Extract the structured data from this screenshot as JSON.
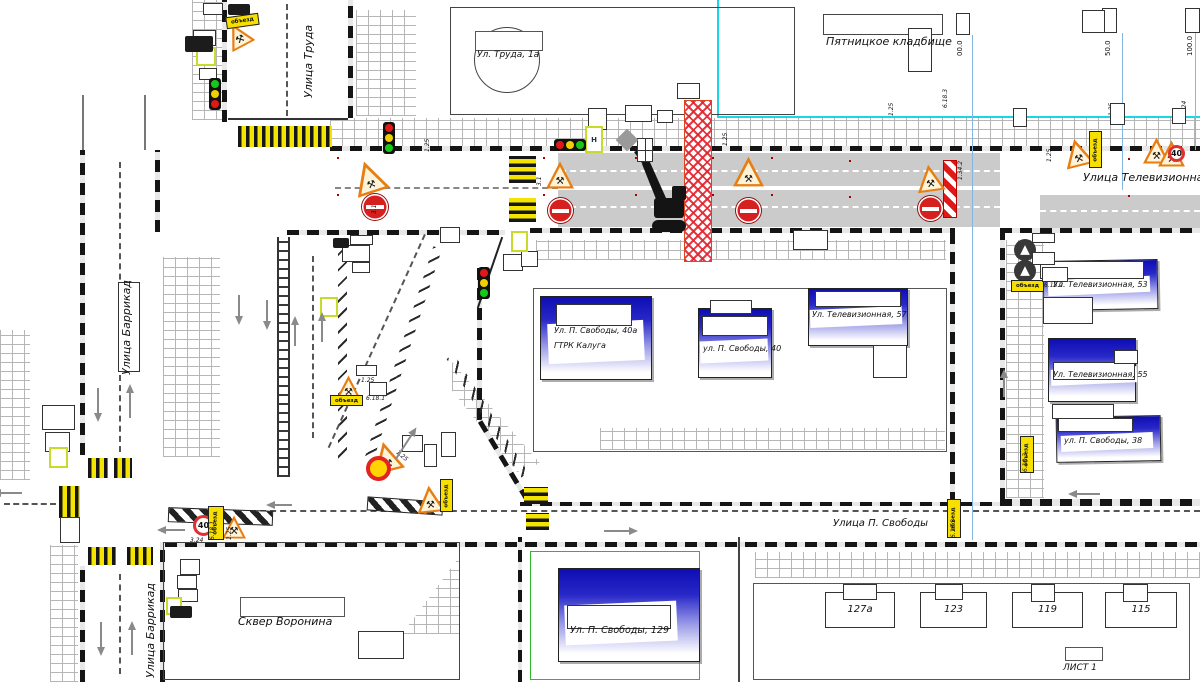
{
  "streets": {
    "truda": "Улица Труда",
    "barrikad_upper": "Улица Баррикад",
    "barrikad_lower": "Улица Баррикад",
    "televizionnaya": "Улица Телевизионная",
    "svobody": "Улица П. Свободы"
  },
  "places": {
    "cemetery": "Пятницкое кладбище",
    "park": "Сквер Воронина",
    "sheet": "ЛИСТ 1"
  },
  "buildings": {
    "truda1a": "Ул. Труда, 1а",
    "svobody40a_line1": "Ул. П. Свободы, 40а",
    "svobody40a_line2": "ГТРК  Калуга",
    "svobody40": "ул. П. Свободы, 40",
    "tv57": "Ул. Телевизионная, 57",
    "tv53": "Ул. Телевизионная, 53",
    "tv55": "Ул. Телевизионная, 55",
    "svobody38": "ул. П. Свободы, 38",
    "svobody129": "Ул. П. Свободы, 129",
    "b127a": "127а",
    "b123": "123",
    "b119": "119",
    "b115": "115"
  },
  "measurements": [
    "00.0",
    "50.0",
    "100.0"
  ],
  "icons": {
    "roadworks-icon": "⚒"
  },
  "colors": {
    "accent_blue_building": "#0d0db4",
    "work_zone_red": "#e12330",
    "crosswalk_yellow": "#f4e400",
    "detour_plate_yellow": "#f7df00",
    "cyan_line": "#18d8e8",
    "closed_lane_gray": "#cbcbcb"
  },
  "markers": [
    {
      "t": "cwv",
      "x": 238,
      "y": 126,
      "w": 94,
      "h": 21
    },
    {
      "t": "cwv",
      "x": 88,
      "y": 458,
      "w": 20,
      "h": 20
    },
    {
      "t": "cwv",
      "x": 114,
      "y": 458,
      "w": 18,
      "h": 20
    },
    {
      "t": "cwv",
      "x": 88,
      "y": 547,
      "w": 28,
      "h": 18
    },
    {
      "t": "cwv",
      "x": 127,
      "y": 547,
      "w": 26,
      "h": 18
    },
    {
      "t": "cwv",
      "x": 59,
      "y": 486,
      "w": 21,
      "h": 32
    },
    {
      "t": "cwh",
      "x": 509,
      "y": 156,
      "w": 27,
      "h": 27
    },
    {
      "t": "cwh",
      "x": 509,
      "y": 198,
      "w": 27,
      "h": 24
    },
    {
      "t": "cwh",
      "x": 524,
      "y": 487,
      "w": 24,
      "h": 17
    },
    {
      "t": "cwh",
      "x": 526,
      "y": 513,
      "w": 23,
      "h": 17
    },
    {
      "t": "bar",
      "x": 168,
      "y": 509,
      "w": 105,
      "h": 15,
      "r": 2
    },
    {
      "t": "bar",
      "x": 367,
      "y": 499,
      "w": 76,
      "h": 14,
      "r": 4
    },
    {
      "t": "post",
      "x": 337,
      "y": 157
    },
    {
      "t": "post",
      "x": 337,
      "y": 194
    },
    {
      "t": "post",
      "x": 543,
      "y": 157
    },
    {
      "t": "post",
      "x": 543,
      "y": 194
    },
    {
      "t": "post",
      "x": 635,
      "y": 157
    },
    {
      "t": "post",
      "x": 635,
      "y": 194
    },
    {
      "t": "post",
      "x": 712,
      "y": 157
    },
    {
      "t": "post",
      "x": 712,
      "y": 194
    },
    {
      "t": "post",
      "x": 771,
      "y": 157
    },
    {
      "t": "post",
      "x": 771,
      "y": 194
    },
    {
      "t": "post",
      "x": 849,
      "y": 160
    },
    {
      "t": "post",
      "x": 849,
      "y": 196
    },
    {
      "t": "post",
      "x": 1128,
      "y": 158
    },
    {
      "t": "post",
      "x": 1128,
      "y": 195
    },
    {
      "t": "chev",
      "x": 943,
      "y": 160,
      "w": 14,
      "h": 58
    },
    {
      "t": "tri",
      "x": 225,
      "y": 22,
      "s": 26,
      "r": -28
    },
    {
      "t": "tri",
      "x": 352,
      "y": 160,
      "s": 34,
      "r": -18
    },
    {
      "t": "tri",
      "x": 546,
      "y": 161,
      "s": 28
    },
    {
      "t": "tri",
      "x": 733,
      "y": 156,
      "s": 31
    },
    {
      "t": "tri",
      "x": 916,
      "y": 164,
      "s": 28,
      "r": -8
    },
    {
      "t": "tri",
      "x": 1063,
      "y": 138,
      "s": 29,
      "r": -14
    },
    {
      "t": "tri",
      "x": 1143,
      "y": 137,
      "s": 27
    },
    {
      "t": "tri",
      "x": 1158,
      "y": 140,
      "s": 27
    },
    {
      "t": "tri",
      "x": 336,
      "y": 375,
      "s": 25
    },
    {
      "t": "tri",
      "x": 371,
      "y": 441,
      "s": 31,
      "r": -14
    },
    {
      "t": "tri",
      "x": 416,
      "y": 485,
      "s": 28,
      "r": -6
    },
    {
      "t": "tri",
      "x": 222,
      "y": 515,
      "s": 24
    },
    {
      "t": "ne",
      "x": 362,
      "y": 194,
      "d": 26
    },
    {
      "t": "ne",
      "x": 548,
      "y": 198,
      "d": 25
    },
    {
      "t": "ne",
      "x": 736,
      "y": 198,
      "d": 25
    },
    {
      "t": "ne",
      "x": 918,
      "y": 196,
      "d": 25
    },
    {
      "t": "s40",
      "x": 193,
      "y": 515,
      "d": 21,
      "label": "40"
    },
    {
      "t": "s40",
      "x": 1168,
      "y": 145,
      "d": 17,
      "label": "40"
    },
    {
      "t": "ts",
      "x": 366,
      "y": 456,
      "d": 25
    },
    {
      "t": "dc",
      "x": 1014,
      "y": 239,
      "d": 22
    },
    {
      "t": "dc",
      "x": 1014,
      "y": 260,
      "d": 22
    },
    {
      "t": "dc",
      "x": 62,
      "y": 520,
      "d": 15
    },
    {
      "t": "ph",
      "x": 226,
      "y": 15,
      "w": 33,
      "h": 12,
      "r": -8,
      "label": "объезд"
    },
    {
      "t": "ph",
      "x": 1011,
      "y": 280,
      "w": 33,
      "h": 12,
      "label": "объезд"
    },
    {
      "t": "ph",
      "x": 330,
      "y": 395,
      "w": 33,
      "h": 11,
      "label": "объезд"
    },
    {
      "t": "pv",
      "x": 1089,
      "y": 131,
      "w": 13,
      "h": 37,
      "label": "объезд"
    },
    {
      "t": "pv",
      "x": 1020,
      "y": 436,
      "w": 14,
      "h": 37,
      "label": "объезд"
    },
    {
      "t": "pv",
      "x": 947,
      "y": 499,
      "w": 14,
      "h": 39,
      "label": "объезд"
    },
    {
      "t": "pv",
      "x": 208,
      "y": 506,
      "w": 16,
      "h": 34,
      "label": "объезд"
    },
    {
      "t": "pv",
      "x": 440,
      "y": 479,
      "w": 13,
      "h": 33,
      "label": "объезд"
    },
    {
      "t": "code",
      "x": 424,
      "y": 152,
      "r": 90,
      "label": "1.25"
    },
    {
      "t": "code",
      "x": 371,
      "y": 214,
      "r": 90,
      "label": "3.1"
    },
    {
      "t": "code",
      "x": 536,
      "y": 186,
      "r": 90,
      "label": "3.1"
    },
    {
      "t": "code",
      "x": 722,
      "y": 146,
      "r": 90,
      "label": "1.25"
    },
    {
      "t": "code",
      "x": 888,
      "y": 116,
      "r": 90,
      "label": "1.25"
    },
    {
      "t": "code",
      "x": 942,
      "y": 108,
      "r": 90,
      "label": "6.18.3"
    },
    {
      "t": "code",
      "x": 957,
      "y": 180,
      "r": 90,
      "label": "1.34.2"
    },
    {
      "t": "code",
      "x": 1108,
      "y": 116,
      "r": 90,
      "label": "1.25"
    },
    {
      "t": "code",
      "x": 1181,
      "y": 114,
      "r": 90,
      "label": "3.24"
    },
    {
      "t": "code",
      "x": 1046,
      "y": 162,
      "r": 90,
      "label": "1.25"
    },
    {
      "t": "code",
      "x": 361,
      "y": 377,
      "label": "1.25"
    },
    {
      "t": "code",
      "x": 366,
      "y": 395,
      "label": "6.18.1"
    },
    {
      "t": "code",
      "x": 399,
      "y": 449,
      "r": -40,
      "label": "1.25"
    },
    {
      "t": "code",
      "x": 428,
      "y": 464,
      "r": 90,
      "label": "6.18.1"
    },
    {
      "t": "code",
      "x": 190,
      "y": 537,
      "label": "3.24"
    },
    {
      "t": "code",
      "x": 209,
      "y": 540,
      "r": 90,
      "label": "6.18.1"
    },
    {
      "t": "code",
      "x": 226,
      "y": 540,
      "r": 90,
      "label": "1.25"
    },
    {
      "t": "code",
      "x": 1044,
      "y": 282,
      "label": "6.18.2"
    },
    {
      "t": "code",
      "x": 1022,
      "y": 472,
      "r": 90,
      "label": "6.18.3"
    },
    {
      "t": "code",
      "x": 950,
      "y": 538,
      "r": 90,
      "label": "6.18.3"
    },
    {
      "t": "box",
      "x": 203,
      "y": 3,
      "w": 20,
      "h": 12
    },
    {
      "t": "box",
      "x": 193,
      "y": 30,
      "w": 23,
      "h": 16
    },
    {
      "t": "box",
      "x": 199,
      "y": 68,
      "w": 18,
      "h": 12
    },
    {
      "t": "box",
      "x": 588,
      "y": 108,
      "w": 19,
      "h": 22
    },
    {
      "t": "box",
      "x": 625,
      "y": 105,
      "w": 27,
      "h": 17
    },
    {
      "t": "box",
      "x": 657,
      "y": 110,
      "w": 16,
      "h": 13
    },
    {
      "t": "box",
      "x": 677,
      "y": 83,
      "w": 23,
      "h": 16
    },
    {
      "t": "box",
      "x": 956,
      "y": 13,
      "w": 14,
      "h": 22
    },
    {
      "t": "box",
      "x": 1102,
      "y": 8,
      "w": 15,
      "h": 25
    },
    {
      "t": "box",
      "x": 1185,
      "y": 8,
      "w": 15,
      "h": 25
    },
    {
      "t": "box",
      "x": 1082,
      "y": 10,
      "w": 23,
      "h": 23
    },
    {
      "t": "box",
      "x": 908,
      "y": 28,
      "w": 24,
      "h": 44
    },
    {
      "t": "box",
      "x": 1013,
      "y": 108,
      "w": 14,
      "h": 19
    },
    {
      "t": "box",
      "x": 1110,
      "y": 103,
      "w": 15,
      "h": 22
    },
    {
      "t": "box",
      "x": 1172,
      "y": 108,
      "w": 14,
      "h": 16
    },
    {
      "t": "box",
      "x": 350,
      "y": 235,
      "w": 23,
      "h": 10
    },
    {
      "t": "box",
      "x": 342,
      "y": 245,
      "w": 28,
      "h": 17
    },
    {
      "t": "box",
      "x": 352,
      "y": 262,
      "w": 18,
      "h": 11
    },
    {
      "t": "box",
      "x": 440,
      "y": 227,
      "w": 20,
      "h": 16
    },
    {
      "t": "box",
      "x": 503,
      "y": 254,
      "w": 20,
      "h": 17
    },
    {
      "t": "box",
      "x": 521,
      "y": 251,
      "w": 17,
      "h": 16
    },
    {
      "t": "box",
      "x": 402,
      "y": 435,
      "w": 21,
      "h": 17
    },
    {
      "t": "box",
      "x": 424,
      "y": 444,
      "w": 13,
      "h": 23
    },
    {
      "t": "box",
      "x": 441,
      "y": 432,
      "w": 15,
      "h": 25
    },
    {
      "t": "box",
      "x": 356,
      "y": 365,
      "w": 21,
      "h": 11
    },
    {
      "t": "box",
      "x": 369,
      "y": 382,
      "w": 18,
      "h": 14
    },
    {
      "t": "box",
      "x": 793,
      "y": 230,
      "w": 35,
      "h": 20
    },
    {
      "t": "box",
      "x": 180,
      "y": 559,
      "w": 20,
      "h": 16
    },
    {
      "t": "box",
      "x": 177,
      "y": 575,
      "w": 20,
      "h": 14
    },
    {
      "t": "box",
      "x": 178,
      "y": 589,
      "w": 20,
      "h": 13
    },
    {
      "t": "box",
      "x": 42,
      "y": 405,
      "w": 33,
      "h": 25
    },
    {
      "t": "box",
      "x": 45,
      "y": 432,
      "w": 25,
      "h": 20
    },
    {
      "t": "box",
      "x": 118,
      "y": 282,
      "w": 22,
      "h": 90
    },
    {
      "t": "box",
      "x": 358,
      "y": 631,
      "w": 46,
      "h": 28
    },
    {
      "t": "box",
      "x": 60,
      "y": 517,
      "w": 20,
      "h": 26
    },
    {
      "t": "box",
      "x": 556,
      "y": 304,
      "w": 76,
      "h": 22
    },
    {
      "t": "box",
      "x": 702,
      "y": 316,
      "w": 66,
      "h": 20
    },
    {
      "t": "box",
      "x": 815,
      "y": 291,
      "w": 86,
      "h": 16
    },
    {
      "t": "box",
      "x": 1040,
      "y": 261,
      "w": 104,
      "h": 18
    },
    {
      "t": "box",
      "x": 1053,
      "y": 362,
      "w": 82,
      "h": 18
    },
    {
      "t": "box",
      "x": 1058,
      "y": 418,
      "w": 75,
      "h": 14
    },
    {
      "t": "box",
      "x": 567,
      "y": 605,
      "w": 104,
      "h": 24
    },
    {
      "t": "box",
      "x": 843,
      "y": 584,
      "w": 34,
      "h": 16
    },
    {
      "t": "box",
      "x": 935,
      "y": 584,
      "w": 28,
      "h": 16
    },
    {
      "t": "box",
      "x": 1031,
      "y": 584,
      "w": 24,
      "h": 18
    },
    {
      "t": "box",
      "x": 1123,
      "y": 584,
      "w": 25,
      "h": 18
    },
    {
      "t": "box",
      "x": 710,
      "y": 300,
      "w": 42,
      "h": 14
    },
    {
      "t": "box",
      "x": 1114,
      "y": 350,
      "w": 24,
      "h": 14
    },
    {
      "t": "box",
      "x": 1052,
      "y": 404,
      "w": 62,
      "h": 15
    },
    {
      "t": "box",
      "x": 1032,
      "y": 233,
      "w": 23,
      "h": 10
    },
    {
      "t": "box",
      "x": 1032,
      "y": 252,
      "w": 23,
      "h": 13
    },
    {
      "t": "box",
      "x": 1042,
      "y": 267,
      "w": 26,
      "h": 15
    },
    {
      "t": "fbox",
      "x": 196,
      "y": 47,
      "w": 20,
      "h": 19
    },
    {
      "t": "fbox",
      "x": 511,
      "y": 231,
      "w": 17,
      "h": 21
    },
    {
      "t": "fbox",
      "x": 166,
      "y": 597,
      "w": 16,
      "h": 18
    },
    {
      "t": "fbox",
      "x": 49,
      "y": 447,
      "w": 19,
      "h": 21
    },
    {
      "t": "fbox",
      "x": 320,
      "y": 297,
      "w": 18,
      "h": 20
    },
    {
      "t": "fbox",
      "x": 585,
      "y": 126,
      "w": 18,
      "h": 27,
      "label": "Н"
    },
    {
      "t": "grid",
      "x": 637,
      "y": 138,
      "w": 16,
      "h": 24
    },
    {
      "t": "dia",
      "x": 619,
      "y": 132,
      "w": 16,
      "h": 16
    },
    {
      "t": "trk",
      "x": 185,
      "y": 36,
      "w": 28,
      "h": 16
    },
    {
      "t": "trk",
      "x": 170,
      "y": 606,
      "w": 22,
      "h": 12
    },
    {
      "t": "trk",
      "x": 333,
      "y": 238,
      "w": 16,
      "h": 10
    },
    {
      "t": "trk",
      "x": 228,
      "y": 4,
      "w": 22,
      "h": 11
    },
    {
      "t": "tlv",
      "x": 209,
      "y": 78,
      "c": [
        "#18c818",
        "#f0d000",
        "#e01818"
      ]
    },
    {
      "t": "tlv",
      "x": 383,
      "y": 122,
      "c": [
        "#e01818",
        "#f0d000",
        "#18c818"
      ]
    },
    {
      "t": "tlv",
      "x": 478,
      "y": 267,
      "c": [
        "#e01818",
        "#f0d000",
        "#18c818"
      ]
    },
    {
      "t": "tlh",
      "x": 554,
      "y": 139,
      "c": [
        "#e01818",
        "#f0d000",
        "#18c818"
      ]
    },
    {
      "t": "ar",
      "x": 97,
      "y": 388,
      "l": 30,
      "r": 180
    },
    {
      "t": "ar",
      "x": 129,
      "y": 388,
      "l": 30,
      "r": 0
    },
    {
      "t": "ar",
      "x": 100,
      "y": 622,
      "l": 30,
      "r": 180
    },
    {
      "t": "ar",
      "x": 131,
      "y": 625,
      "l": 30,
      "r": 0
    },
    {
      "t": "ar",
      "x": 238,
      "y": 295,
      "l": 26,
      "r": 180
    },
    {
      "t": "ar",
      "x": 266,
      "y": 300,
      "l": 26,
      "r": 180
    },
    {
      "t": "ar",
      "x": 294,
      "y": 320,
      "l": 26,
      "r": 0
    },
    {
      "t": "ar",
      "x": 321,
      "y": 316,
      "l": 26,
      "r": 0
    },
    {
      "t": "ar",
      "x": 404,
      "y": 428,
      "l": 34,
      "r": 33
    },
    {
      "t": "ar",
      "x": 618,
      "y": 516,
      "l": 30,
      "r": 90
    },
    {
      "t": "ar",
      "x": 1085,
      "y": 480,
      "l": 28,
      "r": 270
    },
    {
      "t": "ar",
      "x": 172,
      "y": 518,
      "l": 24,
      "r": 270
    },
    {
      "t": "ar",
      "x": 8,
      "y": 480,
      "l": 26,
      "r": 270
    },
    {
      "t": "ar",
      "x": 280,
      "y": 494,
      "l": 22,
      "r": 270
    },
    {
      "t": "ar",
      "x": 1003,
      "y": 373,
      "l": 24,
      "r": 0
    }
  ]
}
